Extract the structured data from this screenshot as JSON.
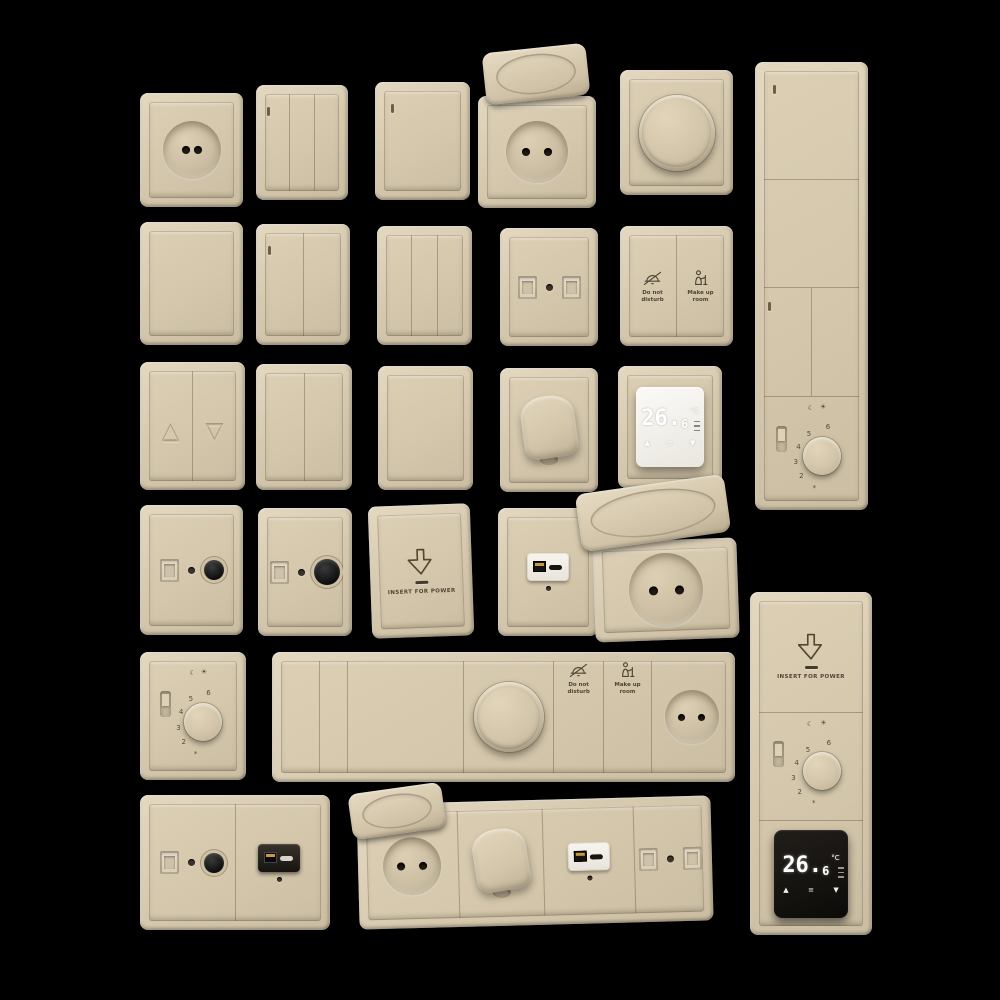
{
  "scene_title": "beige-wall-switch-socket-collection",
  "palette": {
    "background": "#000000",
    "beige": "#d6c9ae",
    "beige_highlight": "#e4d8bf",
    "beige_shadow": "#c0b297",
    "ink": "#4f4534",
    "module_white": "#f2efe9",
    "module_black": "#14110e",
    "usb_gold": "#c59a45"
  },
  "labels": {
    "do_not": "Do not",
    "disturb": "disturb",
    "make_up": "Make up",
    "room": "room",
    "insert_for_power": "INSERT FOR POWER"
  },
  "thermo": {
    "reading_main": "26.",
    "reading_sub": "6",
    "unit": "°C",
    "up": "▲",
    "down": "▼",
    "menu": "≡"
  },
  "dial": {
    "numbers": [
      "6",
      "5",
      "4",
      "3",
      "2"
    ],
    "moon": "☾",
    "sun": "☀",
    "frost": "*"
  },
  "blinds": {
    "up": "△",
    "down": "▽"
  },
  "devices": [
    {
      "name": "socket-1gang",
      "type": "socket",
      "rect": [
        140,
        93,
        103,
        114
      ],
      "well": [
        58,
        6,
        8
      ]
    },
    {
      "name": "switch-3gang-indicator",
      "type": "switch",
      "rect": [
        256,
        85,
        92,
        115
      ],
      "gangs": 3,
      "ind": [
        0
      ]
    },
    {
      "name": "switch-1gang-indicator",
      "type": "switch",
      "rect": [
        375,
        82,
        95,
        118
      ],
      "gangs": 1,
      "ind": [
        0
      ]
    },
    {
      "name": "socket-flip-lid",
      "type": "socket",
      "rect": [
        478,
        96,
        118,
        112
      ],
      "well": [
        62,
        11,
        8
      ],
      "lid": [
        484,
        48,
        104,
        52,
        -6
      ]
    },
    {
      "name": "rotary-dimmer",
      "type": "dimmer",
      "rect": [
        620,
        70,
        113,
        125
      ],
      "knob": 76
    },
    {
      "name": "multi-switch-panel-vertical",
      "type": "panel",
      "rect": [
        755,
        62,
        113,
        448
      ],
      "dir": "column",
      "segs": [
        {
          "t": "sw",
          "size": 25,
          "ind": true
        },
        {
          "t": "sw",
          "size": 25
        },
        {
          "t": "sw2",
          "size": 25
        },
        {
          "t": "dial",
          "size": 25
        }
      ]
    },
    {
      "name": "switch-1gang-plain",
      "type": "switch",
      "rect": [
        140,
        222,
        103,
        123
      ],
      "gangs": 1
    },
    {
      "name": "switch-2gang-indicator",
      "type": "switch",
      "rect": [
        256,
        224,
        94,
        121
      ],
      "gangs": 2,
      "ind": [
        0
      ]
    },
    {
      "name": "switch-3gang-plain",
      "type": "switch",
      "rect": [
        377,
        226,
        95,
        119
      ],
      "gangs": 3
    },
    {
      "name": "data-socket-double",
      "type": "data",
      "rect": [
        500,
        228,
        98,
        118
      ]
    },
    {
      "name": "dnd-mur-switch",
      "type": "dnd",
      "rect": [
        620,
        226,
        113,
        120
      ]
    },
    {
      "name": "blinds-switch",
      "type": "blinds",
      "rect": [
        140,
        362,
        105,
        128
      ]
    },
    {
      "name": "switch-2gang",
      "type": "switch",
      "rect": [
        256,
        364,
        96,
        126
      ],
      "gangs": 2
    },
    {
      "name": "switch-1gang",
      "type": "switch",
      "rect": [
        378,
        366,
        95,
        124
      ],
      "gangs": 1
    },
    {
      "name": "cable-outlet",
      "type": "cable",
      "rect": [
        500,
        368,
        98,
        124
      ]
    },
    {
      "name": "digital-thermostat-white",
      "type": "thermo",
      "rect": [
        618,
        366,
        104,
        122
      ],
      "variant": "white"
    },
    {
      "name": "tv-coax-socket",
      "type": "tv",
      "rect": [
        140,
        505,
        103,
        130
      ]
    },
    {
      "name": "tv-coax-socket-large",
      "type": "tv",
      "rect": [
        258,
        508,
        94,
        128
      ],
      "big": true
    },
    {
      "name": "keycard-power-switch",
      "type": "keycard",
      "rect": [
        370,
        505,
        102,
        132
      ],
      "rot": -2
    },
    {
      "name": "usb-charger-socket",
      "type": "usb",
      "rect": [
        498,
        508,
        100,
        128
      ]
    },
    {
      "name": "socket-flip-lid-large",
      "type": "socket",
      "rect": [
        594,
        540,
        144,
        100
      ],
      "well": [
        74,
        13,
        9
      ],
      "rot": -2,
      "lid": [
        578,
        484,
        150,
        58,
        -8
      ]
    },
    {
      "name": "dial-thermostat",
      "type": "dial",
      "rect": [
        140,
        652,
        106,
        128
      ]
    },
    {
      "name": "hotel-strip-panel",
      "type": "panel",
      "rect": [
        272,
        652,
        463,
        130
      ],
      "dir": "row",
      "segs": [
        {
          "t": "sw",
          "size": 8.5
        },
        {
          "t": "sw",
          "size": 6
        },
        {
          "t": "sw",
          "size": 26
        },
        {
          "t": "dimmer",
          "size": 20,
          "knob": 70
        },
        {
          "t": "dnd1",
          "size": 11
        },
        {
          "t": "dnd2",
          "size": 10.5
        },
        {
          "t": "socket",
          "size": 18,
          "well": [
            54,
            10,
            7
          ]
        }
      ]
    },
    {
      "name": "tv-usb-combo",
      "type": "panel",
      "rect": [
        140,
        795,
        190,
        135
      ],
      "dir": "row",
      "segs": [
        {
          "t": "tv",
          "size": 50
        },
        {
          "t": "usbblack",
          "size": 50
        }
      ]
    },
    {
      "name": "socket-combo-strip",
      "type": "panel",
      "rect": [
        358,
        800,
        354,
        125
      ],
      "dir": "row",
      "rot": -1.5,
      "lid": [
        350,
        788,
        94,
        46,
        -8
      ],
      "segs": [
        {
          "t": "socket",
          "size": 27,
          "well": [
            58,
            11,
            8
          ]
        },
        {
          "t": "cable",
          "size": 25
        },
        {
          "t": "usb",
          "size": 27
        },
        {
          "t": "data",
          "size": 21
        }
      ]
    },
    {
      "name": "hotel-panel-vertical",
      "type": "panel",
      "rect": [
        750,
        592,
        122,
        343
      ],
      "dir": "column",
      "segs": [
        {
          "t": "keycard",
          "size": 34
        },
        {
          "t": "dial",
          "size": 33
        },
        {
          "t": "thermoblack",
          "size": 33
        }
      ]
    }
  ]
}
